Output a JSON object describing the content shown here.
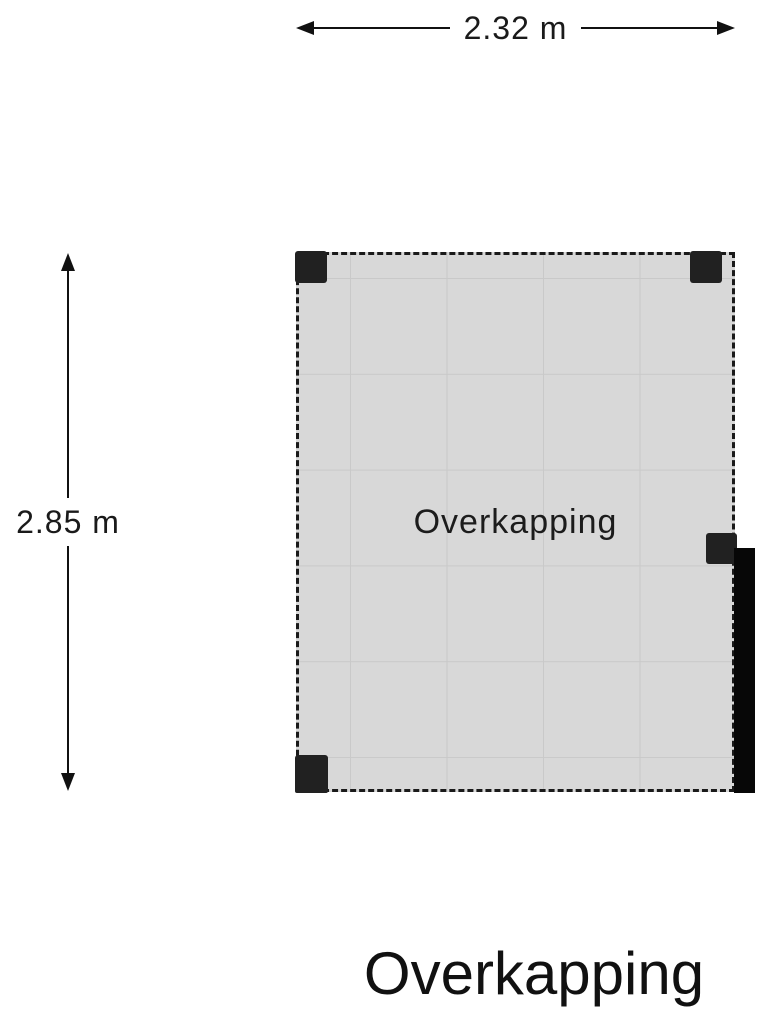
{
  "title": "Overkapping",
  "plan": {
    "room_label": "Overkapping",
    "width_m": 2.32,
    "height_m": 2.85
  },
  "dimensions": {
    "width_label": "2.32 m",
    "height_label": "2.85 m"
  },
  "icons": {
    "dimension_arrows": [
      "arrowhead-left-icon",
      "arrowhead-right-icon",
      "arrowhead-up-icon",
      "arrowhead-down-icon"
    ]
  },
  "colors": {
    "background": "#ffffff",
    "floor_fill": "#d8d8d8",
    "tile_grid_line": "#c9c9c9",
    "dashed_outline": "#1a1a1a",
    "post": "#212121",
    "wall": "#070707",
    "text": "#111111"
  }
}
